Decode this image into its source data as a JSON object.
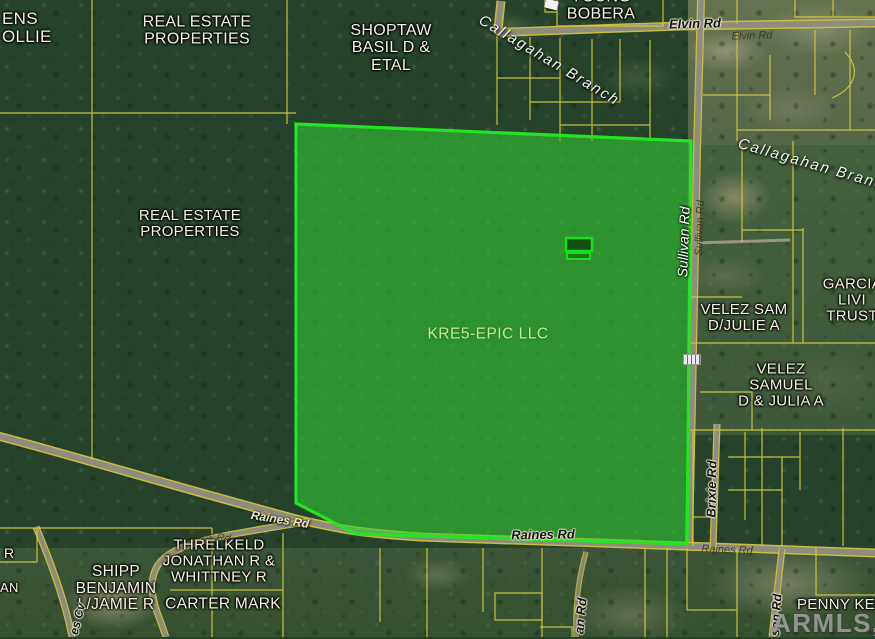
{
  "map": {
    "watermark": "ARMLS, INC",
    "colors": {
      "highlight_outline": "#23e523",
      "highlight_fill": "rgba(50,205,50,0.58)",
      "parcel_line": "#d6ca41"
    },
    "parcels": {
      "ens_ollie": "ENS\nOLLIE",
      "real_estate_top": "REAL ESTATE\nPROPERTIES",
      "shoptaw": "SHOPTAW\nBASIL D &\nETAL",
      "young_bobera": "YOUNG\nBOBERA",
      "real_estate_mid": "REAL ESTATE\nPROPERTIES",
      "kre5_epic": "KRE5-EPIC LLC",
      "velez_sam": "VELEZ SAM\nD/JULIE A",
      "garcia_trust": "GARCIA LIVI\nTRUST",
      "velez_samuel": "VELEZ SAMUEL\nD & JULIA A",
      "threlkeld": "THRELKELD\nJONATHAN R &\nWHITTNEY R",
      "shipp": "SHIPP\nBENJAMIN\nL/JAMIE R",
      "carter": "CARTER MARK",
      "penny": "PENNY KELSI",
      "partial_r": "R",
      "partial_an": "AN"
    },
    "roads": {
      "elvin_main": "Elvin Rd",
      "elvin_faint": "Elvin Rd",
      "sullivan_main": "Sullivan Rd",
      "sullivan_faint": "Sullivan Rd",
      "brixie": "Brixie Rd",
      "raines_diag": "Raines Rd",
      "raines_faint_left": "Raines Rd",
      "raines_main": "Raines Rd",
      "raines_faint_right": "Raines Rd",
      "es_cv": "es Cv",
      "an_rd": "an Rd",
      "son_rd": "son Rd"
    },
    "streams": {
      "callagahan_top": "Callagahan Branch",
      "callagahan_right": "Callagahan Branch"
    }
  }
}
